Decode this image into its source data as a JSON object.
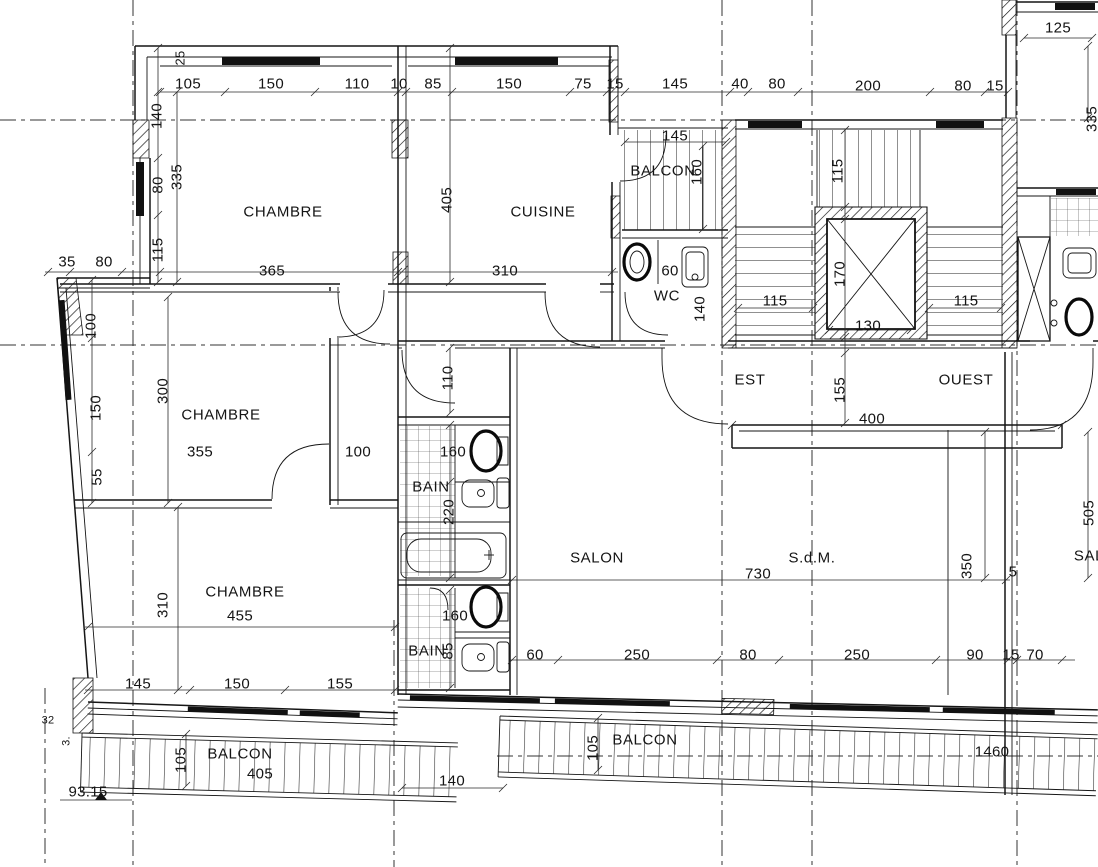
{
  "drawing": {
    "kind": "architectural floor plan",
    "language": "French"
  },
  "colors": {
    "line": "#151515",
    "background": "#ffffff"
  },
  "rooms": [
    {
      "label": "CHAMBRE",
      "x": 283,
      "y": 212
    },
    {
      "label": "CUISINE",
      "x": 543,
      "y": 212
    },
    {
      "label": "BALCON",
      "x": 663,
      "y": 171
    },
    {
      "label": "WC",
      "x": 667,
      "y": 296
    },
    {
      "label": "EST",
      "x": 750,
      "y": 380
    },
    {
      "label": "OUEST",
      "x": 966,
      "y": 380
    },
    {
      "label": "CHAMBRE",
      "x": 221,
      "y": 415
    },
    {
      "label": "BAIN",
      "x": 431,
      "y": 487
    },
    {
      "label": "SALON",
      "x": 597,
      "y": 558
    },
    {
      "label": "S.d.M.",
      "x": 812,
      "y": 558
    },
    {
      "label": "CHAMBRE",
      "x": 245,
      "y": 592
    },
    {
      "label": "BAIN",
      "x": 427,
      "y": 651
    },
    {
      "label": "BALCON",
      "x": 240,
      "y": 754
    },
    {
      "label": "BALCON",
      "x": 645,
      "y": 740
    },
    {
      "label": "SAL",
      "x": 1089,
      "y": 556
    }
  ],
  "dims_h": [
    {
      "v": "105",
      "x": 188,
      "y": 84
    },
    {
      "v": "150",
      "x": 271,
      "y": 84
    },
    {
      "v": "110",
      "x": 357,
      "y": 84
    },
    {
      "v": "10",
      "x": 399,
      "y": 84
    },
    {
      "v": "85",
      "x": 433,
      "y": 84
    },
    {
      "v": "150",
      "x": 509,
      "y": 84
    },
    {
      "v": "75",
      "x": 583,
      "y": 84
    },
    {
      "v": "15",
      "x": 615,
      "y": 84
    },
    {
      "v": "145",
      "x": 675,
      "y": 84
    },
    {
      "v": "40",
      "x": 740,
      "y": 84
    },
    {
      "v": "80",
      "x": 777,
      "y": 84
    },
    {
      "v": "200",
      "x": 868,
      "y": 86
    },
    {
      "v": "80",
      "x": 963,
      "y": 86
    },
    {
      "v": "15",
      "x": 995,
      "y": 86
    },
    {
      "v": "125",
      "x": 1058,
      "y": 28
    },
    {
      "v": "35",
      "x": 67,
      "y": 262
    },
    {
      "v": "80",
      "x": 104,
      "y": 262
    },
    {
      "v": "365",
      "x": 272,
      "y": 271
    },
    {
      "v": "310",
      "x": 505,
      "y": 271
    },
    {
      "v": "145",
      "x": 675,
      "y": 136
    },
    {
      "v": "60",
      "x": 670,
      "y": 271
    },
    {
      "v": "115",
      "x": 775,
      "y": 301
    },
    {
      "v": "115",
      "x": 966,
      "y": 301
    },
    {
      "v": "130",
      "x": 868,
      "y": 326
    },
    {
      "v": "400",
      "x": 872,
      "y": 419
    },
    {
      "v": "355",
      "x": 200,
      "y": 452
    },
    {
      "v": "100",
      "x": 358,
      "y": 452
    },
    {
      "v": "160",
      "x": 453,
      "y": 452
    },
    {
      "v": "730",
      "x": 758,
      "y": 574
    },
    {
      "v": "5",
      "x": 1013,
      "y": 572
    },
    {
      "v": "455",
      "x": 240,
      "y": 616
    },
    {
      "v": "160",
      "x": 455,
      "y": 616
    },
    {
      "v": "60",
      "x": 535,
      "y": 655
    },
    {
      "v": "250",
      "x": 637,
      "y": 655
    },
    {
      "v": "80",
      "x": 748,
      "y": 655
    },
    {
      "v": "250",
      "x": 857,
      "y": 655
    },
    {
      "v": "90",
      "x": 975,
      "y": 655
    },
    {
      "v": "15",
      "x": 1011,
      "y": 655
    },
    {
      "v": "70",
      "x": 1035,
      "y": 655
    },
    {
      "v": "145",
      "x": 138,
      "y": 684
    },
    {
      "v": "150",
      "x": 237,
      "y": 684
    },
    {
      "v": "155",
      "x": 340,
      "y": 684
    },
    {
      "v": "405",
      "x": 260,
      "y": 774
    },
    {
      "v": "140",
      "x": 452,
      "y": 781
    },
    {
      "v": "1460",
      "x": 992,
      "y": 752
    },
    {
      "v": "93.15",
      "x": 88,
      "y": 792
    },
    {
      "v": "32",
      "x": 48,
      "y": 721,
      "fs": 11
    }
  ],
  "dims_v": [
    {
      "v": "25",
      "x": 180,
      "y": 58,
      "fs": 13
    },
    {
      "v": "140",
      "x": 157,
      "y": 116
    },
    {
      "v": "335",
      "x": 177,
      "y": 177
    },
    {
      "v": "80",
      "x": 158,
      "y": 185
    },
    {
      "v": "115",
      "x": 158,
      "y": 250
    },
    {
      "v": "100",
      "x": 91,
      "y": 326
    },
    {
      "v": "150",
      "x": 96,
      "y": 408
    },
    {
      "v": "55",
      "x": 97,
      "y": 477
    },
    {
      "v": "300",
      "x": 163,
      "y": 391
    },
    {
      "v": "310",
      "x": 163,
      "y": 605
    },
    {
      "v": "405",
      "x": 447,
      "y": 200
    },
    {
      "v": "110",
      "x": 448,
      "y": 378
    },
    {
      "v": "220",
      "x": 449,
      "y": 512
    },
    {
      "v": "85",
      "x": 448,
      "y": 651
    },
    {
      "v": "160",
      "x": 697,
      "y": 172
    },
    {
      "v": "115",
      "x": 838,
      "y": 171
    },
    {
      "v": "170",
      "x": 840,
      "y": 274
    },
    {
      "v": "155",
      "x": 840,
      "y": 390
    },
    {
      "v": "140",
      "x": 700,
      "y": 309
    },
    {
      "v": "350",
      "x": 967,
      "y": 566
    },
    {
      "v": "505",
      "x": 1089,
      "y": 513
    },
    {
      "v": "335",
      "x": 1092,
      "y": 119
    },
    {
      "v": "105",
      "x": 181,
      "y": 760
    },
    {
      "v": "105",
      "x": 593,
      "y": 748
    },
    {
      "v": "3.",
      "x": 67,
      "y": 741,
      "fs": 11
    }
  ]
}
